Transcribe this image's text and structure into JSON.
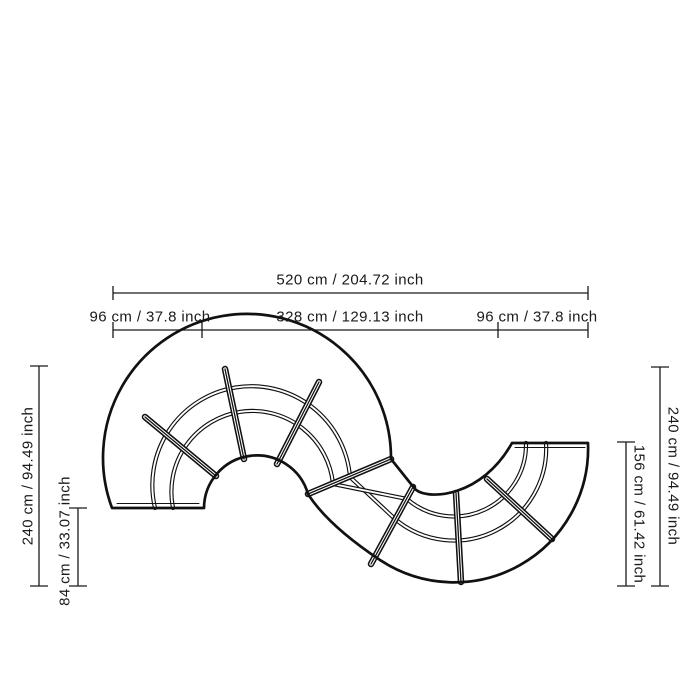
{
  "drawing": {
    "subject": "S-shaped serpentine modular sofa, top view dimension drawing",
    "line_color": "#111111",
    "background_color": "#ffffff",
    "module_count": 8
  },
  "dimensions": {
    "total_width": "520 cm / 204.72 inch",
    "left_section_width": "96 cm / 37.8 inch",
    "middle_section_width": "328 cm / 129.13 inch",
    "right_section_width": "96 cm / 37.8 inch",
    "left_total_depth": "240 cm / 94.49 inch",
    "left_end_depth": "84 cm / 33.07 inch",
    "right_total_depth": "240 cm / 94.49 inch",
    "right_end_depth": "156 cm / 61.42 inch"
  }
}
